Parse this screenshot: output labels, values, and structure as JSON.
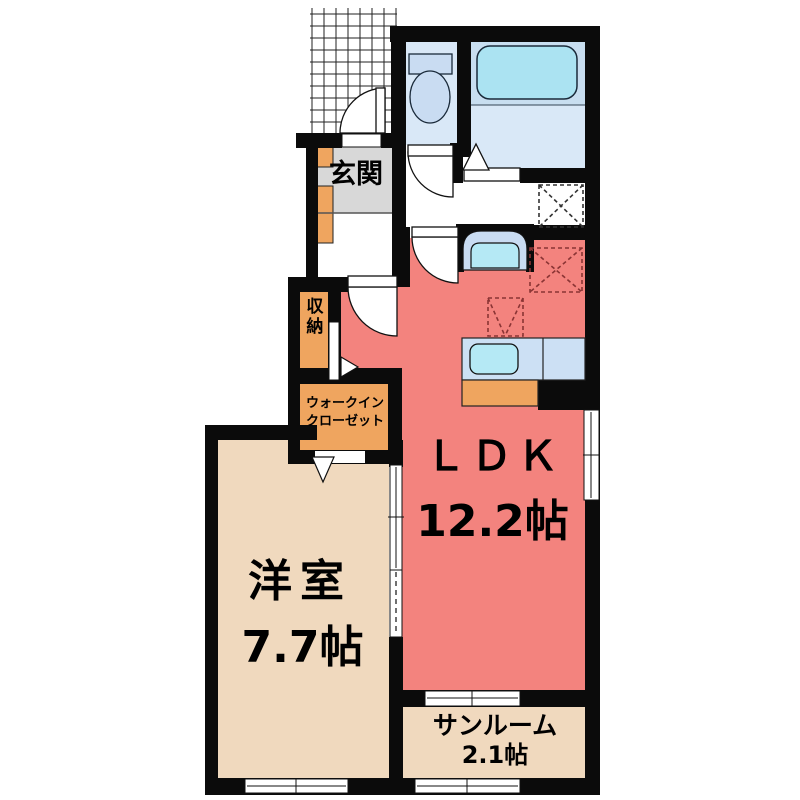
{
  "plan_title": "apartment-floor-plan",
  "rooms": {
    "ldk": {
      "name": "ＬＤＫ",
      "area": "12.2帖"
    },
    "western": {
      "name": "洋室",
      "area": "7.7帖"
    },
    "sunroom": {
      "name": "サンルーム",
      "area": "2.1帖"
    },
    "entrance": {
      "name": "玄関"
    },
    "storage": {
      "name": "収納"
    },
    "wic": {
      "line1": "ウォークイン",
      "line2": "クローゼット"
    }
  },
  "colors": {
    "wall": "#0b0b0b",
    "ldk": "#F3837E",
    "western": "#F0D9BE",
    "sunroom": "#F0D9BE",
    "storage": "#EFA55F",
    "entrance_floor": "#D8D8D8",
    "wet_area": "#D9E8F7",
    "bath_zone": "#C8DEF0",
    "bathtub": "#ABE3F2",
    "fixture": "#C9DCF2",
    "sink": "#B5E9F5",
    "counter": "#CCE0F4"
  }
}
